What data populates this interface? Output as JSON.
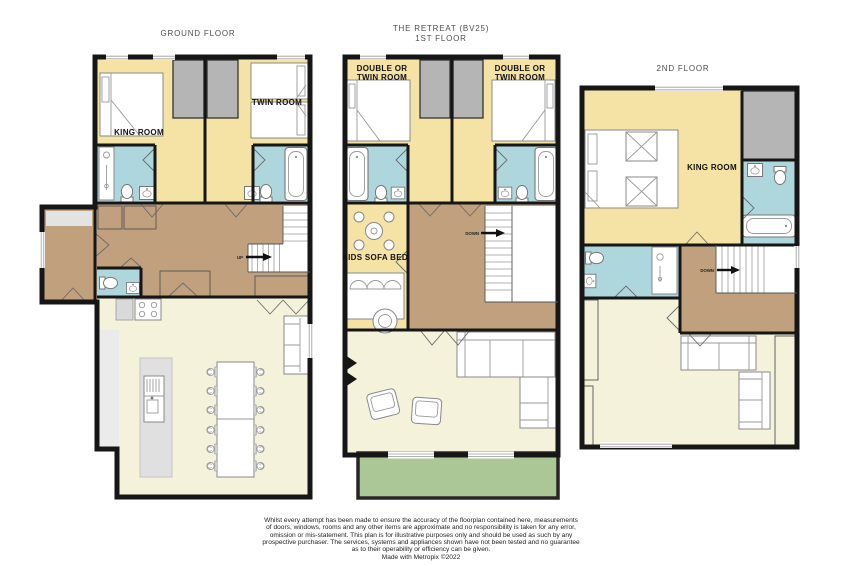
{
  "titles": {
    "ground": "GROUND FLOOR",
    "property": "THE RETREAT (BV25)",
    "first": "1ST FLOOR",
    "second": "2ND FLOOR"
  },
  "room_labels": {
    "ground_king": "KING ROOM",
    "ground_twin": "TWIN ROOM",
    "first_left_line1": "DOUBLE OR",
    "first_left_line2": "TWIN ROOM",
    "first_right_line1": "DOUBLE OR",
    "first_right_line2": "TWIN ROOM",
    "first_kids": "KIDS SOFA BED",
    "second_king": "KING ROOM"
  },
  "stair_labels": {
    "ground": "UP",
    "first": "DOWN",
    "second": "DOWN"
  },
  "footer": {
    "disclaimer_lines": [
      "Whilst every attempt has been made to ensure the accuracy of the floorplan contained here, measurements",
      "of doors, windows, rooms and any other items are approximate and no responsibility is taken for any error,",
      "omission or mis-statement. This plan is for illustrative purposes only and should be used as such by any",
      "prospective purchaser. The services, systems and appliances shown have not been tested and no guarantee",
      "as to their operability or efficiency can be given."
    ],
    "credit": "Made with Metropix ©2022"
  },
  "legend_colors": {
    "wall": "#161616",
    "bedroom": "#f5e3a5",
    "bathroom": "#aed7dd",
    "hallway": "#c0a07d",
    "living_kitchen": "#f5f2dc",
    "balcony": "#abc795",
    "storage_closet": "#b5b5b5",
    "island": "#e0e0e0"
  }
}
